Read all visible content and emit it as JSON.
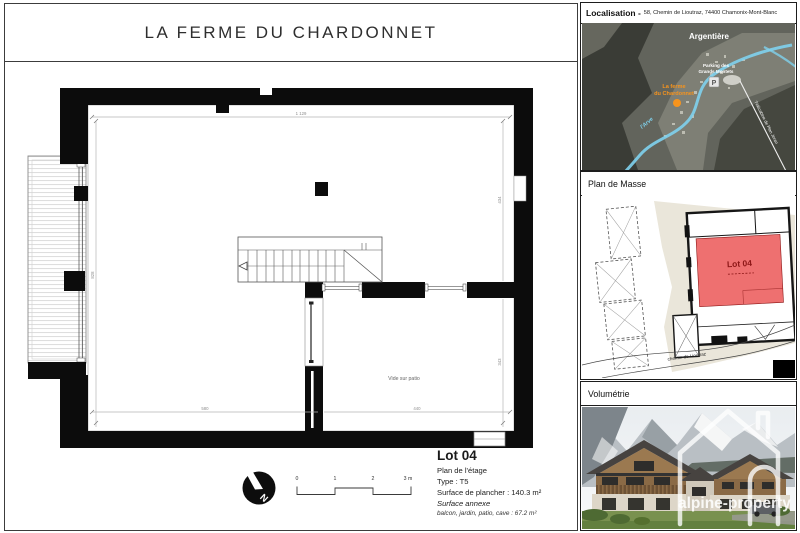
{
  "document": {
    "title": "LA FERME DU CHARDONNET"
  },
  "plan": {
    "dims": {
      "top": "1 129",
      "left": "828",
      "right_upper": "434",
      "right_lower": "343",
      "bottom_left": "580",
      "bottom_right": "440"
    },
    "vide_label": "Vide sur patio",
    "north": "N",
    "scale_ticks": [
      "0",
      "1",
      "2",
      "3 m"
    ]
  },
  "lot_info": {
    "title": "Lot 04",
    "floor": "Plan de l'étage",
    "type": "Type : T5",
    "surface": "Surface de plancher : 140.3 m²",
    "annex_title": "Surface annexe",
    "annex_detail": "balcon, jardin, patio, cave : 67.2 m²"
  },
  "sidebar": {
    "localisation": {
      "label": "Localisation -",
      "address": "58, Chemin de Lioutraz, 74400 Chamonix-Mont-Blanc",
      "map": {
        "town": "Argentière",
        "parking_line1": "Parking des",
        "parking_line2": "Grands Montets",
        "parking_icon": "P",
        "property_line1": "La ferme",
        "property_line2": "du Chardonnet",
        "river": "l'Arve",
        "lift": "Télécabine de Plan Joran"
      }
    },
    "plan_masse": {
      "header": "Plan de Masse",
      "lot": "Lot 04",
      "road": "chemin de Lioutraz"
    },
    "volumetrie": {
      "header": "Volumétrie",
      "watermark": "alpine-property"
    }
  },
  "colors": {
    "accent_orange": "#f7941d",
    "lot_red_fill": "#ee7070",
    "lot_red_text": "#8c1616",
    "river_blue": "#7fd2ee",
    "terrain_beige": "#eae6da"
  }
}
